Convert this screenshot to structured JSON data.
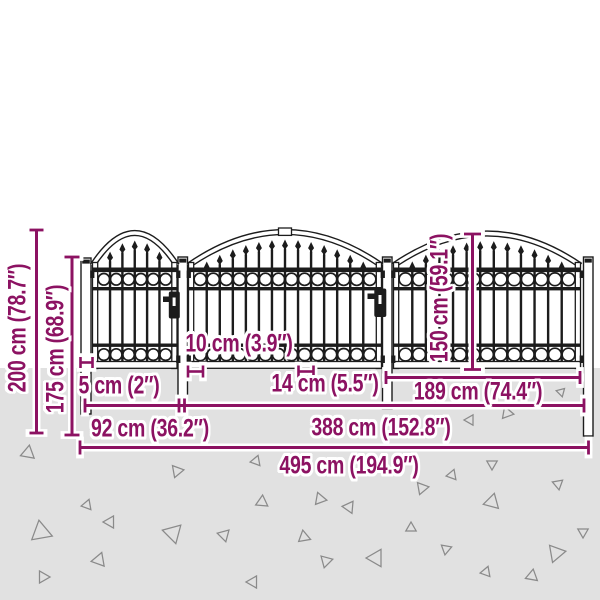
{
  "labels": {
    "height_total": "200 cm (78.7″)",
    "height_post": "175 cm (68.9″)",
    "height_panel": "150 cm (59.1″)",
    "spacing_small": "10 cm (3.9″)",
    "post_width": "5 cm (2″)",
    "spacing_large": "14 cm (5.5″)",
    "panel_width": "189 cm (74.4″)",
    "gate_width": "92 cm (36.2″)",
    "section_width": "388 cm (152.8″)",
    "total_width": "495 cm (194.9″)"
  },
  "colors": {
    "dimension": "#8c1262",
    "fence": "#1c1c1c",
    "ground": "#e1e1e1",
    "gravel": "#8a8a8a",
    "background": "#ffffff"
  }
}
